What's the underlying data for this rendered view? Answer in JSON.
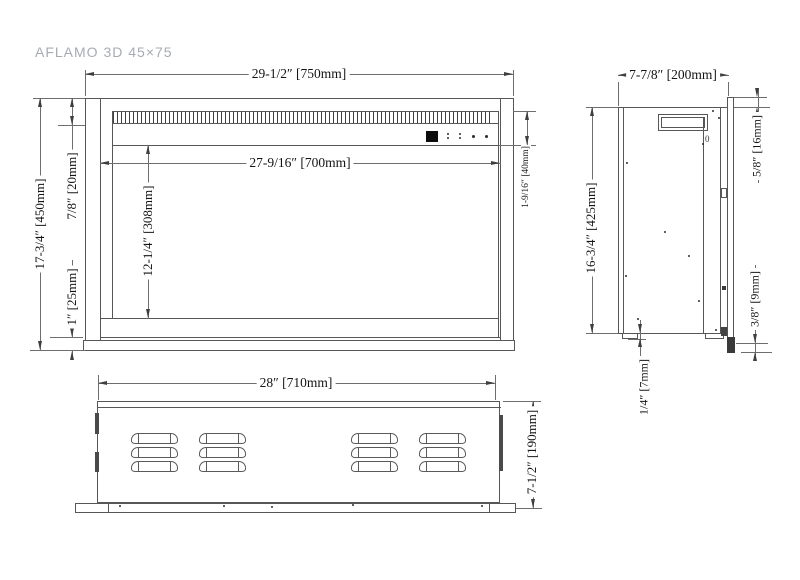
{
  "title": "AFLAMO 3D 45×75",
  "front_view": {
    "dimensions": {
      "overall_width": "29-1/2″ [750mm]",
      "opening_width": "27-9/16″ [700mm]",
      "overall_height": "17-3/4″ [450mm]",
      "top_frame": "7/8″ [20mm]",
      "bottom_frame": "1″ [25mm]",
      "opening_height": "12-1/4″ [308mm]",
      "vent_control_band": "1-9/16″ [40mm]"
    },
    "control_panel": {
      "display_icon": "black-square-display",
      "button_icons": [
        "double-dot",
        "double-dot",
        "dot",
        "dot"
      ]
    }
  },
  "side_view": {
    "dimensions": {
      "overall_depth": "7-7/8″ [200mm]",
      "flange_above_top": "5/8″ [16mm]",
      "overall_height": "16-3/4″ [425mm]",
      "foot_height": "1/4″ [7mm]",
      "flange_below_bottom": "3/8″ [9mm]"
    },
    "marking": "0"
  },
  "bottom_view": {
    "dimensions": {
      "body_width": "28″ [710mm]",
      "body_depth": "7-1/2″ [190mm]"
    }
  },
  "colors": {
    "line": "#575757",
    "dim_line": "#6e6e6e",
    "text": "#141414",
    "title": "#a7abb2",
    "background": "#ffffff"
  }
}
